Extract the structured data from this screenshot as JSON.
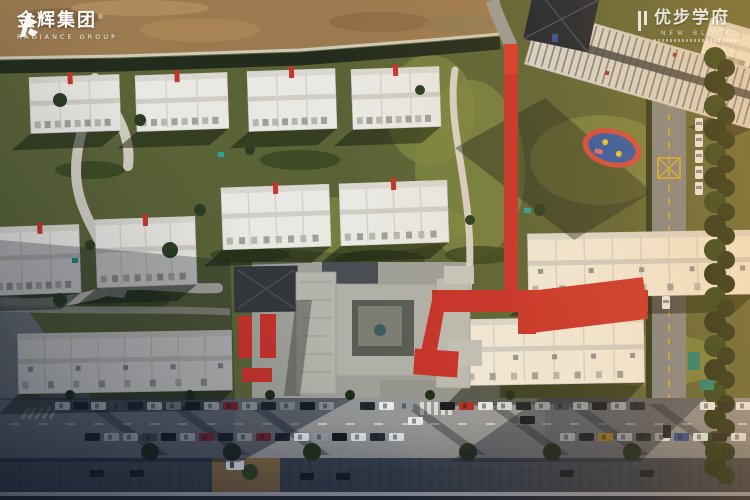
{
  "scene": {
    "type": "aerial-photograph",
    "subject": "Aerial drone view of a residential community with white low-rise housing rows, red pedestrian spine road, central school complex, street parking and construction ground",
    "palette": {
      "lawn": "#5a6336",
      "sunlit_lawn": "#7c8743",
      "dirt_ground": "#9b7a50",
      "asphalt_road": "#84888d",
      "red_path": "#c5322a",
      "building_white": "#e9e8e3",
      "school_gray": "#a7a8a0",
      "dark_roof": "#1b2330",
      "tree_green": "#1f2e1a",
      "shadow_blue": "#10172a",
      "warm_sunlight": "#ffac46",
      "playground_blue": "#2b57a9"
    }
  },
  "watermarks": {
    "radiance": {
      "brand_cn": "金辉集团",
      "registered": "®",
      "brand_en": "RADIANCE GROUP"
    },
    "project": {
      "name_cn": "优步学府",
      "name_en": "NEW BLOCK"
    }
  }
}
